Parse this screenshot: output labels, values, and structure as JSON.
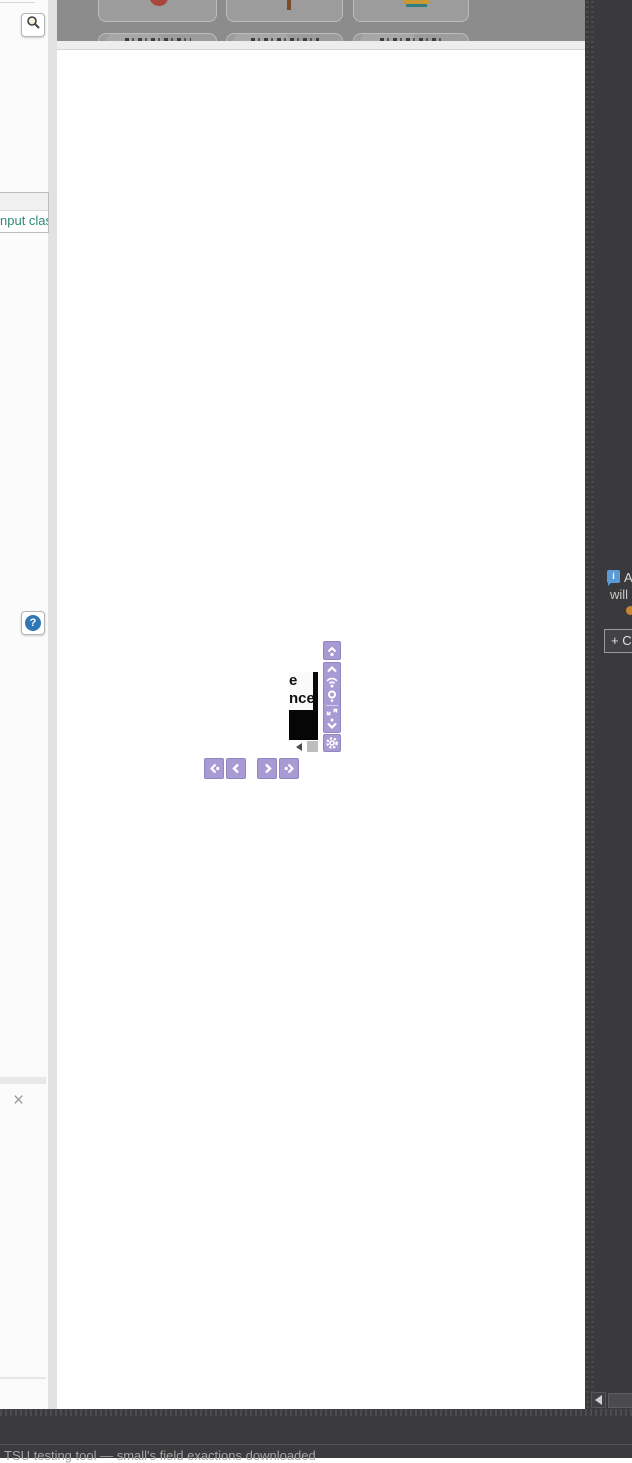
{
  "colors": {
    "accent_purple": "#a89bd4",
    "purple_border": "#9186c2",
    "dark_panel": "#3a3a3c",
    "code_teal": "#2e8b74",
    "info_blue": "#5b9bd5",
    "dim_overlay": "#8c8c8c",
    "status_orange": "#c9862e"
  },
  "left_panel": {
    "search_button": {
      "icon": "magnifier-icon"
    },
    "code_tooltip": {
      "text": "nput class"
    },
    "help_button": {
      "icon": "question-mark-icon",
      "glyph": "?"
    },
    "close_label": "×"
  },
  "main": {
    "dimmed_cards": {
      "rows": 2,
      "columns": 3,
      "captions_legible": false
    },
    "magnifier_popup": {
      "line1": "e",
      "line2": "nce"
    }
  },
  "toolbar": {
    "vertical_icons": [
      "jump-to-top",
      "chevron-up",
      "signal",
      "target-circle",
      "fit-to-screen",
      "jump-to-bottom",
      "settings-gear"
    ],
    "nav_buttons": [
      "go-first",
      "go-previous",
      "go-next",
      "go-last"
    ]
  },
  "right_panel": {
    "info_icon_glyph": "i",
    "info_text_line1": "A",
    "info_text_line2": "will",
    "create_button_label": "+ C"
  },
  "bottom_bar": {
    "status_text": "TSU testing tool — small's field exactions downloaded"
  }
}
